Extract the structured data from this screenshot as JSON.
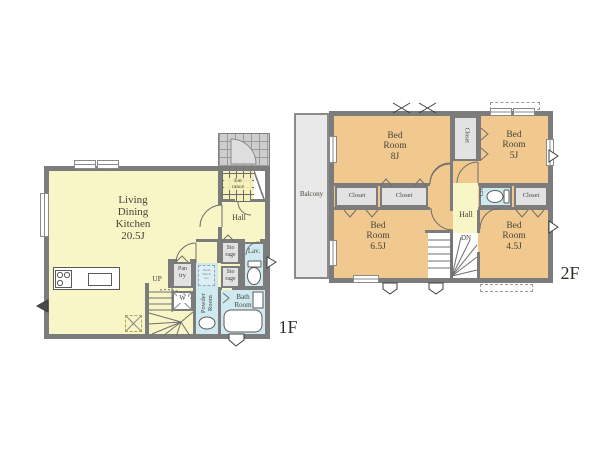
{
  "title": "Floor plan 4LDK (1F / 2F)",
  "colors": {
    "room_yellow": "#f8f5c6",
    "room_orange": "#f1c88e",
    "wet_blue": "#cfe9f0",
    "closet_gray": "#e2e2e2",
    "wall_gray": "#7c7c7c",
    "balcony_gray": "#e9e9e9",
    "text": "#45453c"
  },
  "f1": {
    "floor_label": "1F",
    "ldk": "Living\nDining\nKitchen\n20.5J",
    "entrance": "Ent\nrance",
    "hall": "Hall",
    "storage_top": "Sto\nrage",
    "storage_bottom": "Sto\nrage",
    "lav": "Lav.",
    "pantry": "Pan\ntry",
    "washer": "W",
    "wash_space": "Wash\nMach\nine",
    "powder": "Powder\nRoom",
    "bath": "Bath\nRoom",
    "up": "UP"
  },
  "f2": {
    "floor_label": "2F",
    "balcony": "Balcony",
    "bed_8": "Bed\nRoom\n8J",
    "bed_5": "Bed\nRoom\n5J",
    "bed_65": "Bed\nRoom\n6.5J",
    "bed_45": "Bed\nRoom\n4.5J",
    "closet": "Closet",
    "hall": "Hall",
    "lav": "Lav",
    "dn": "DN"
  }
}
